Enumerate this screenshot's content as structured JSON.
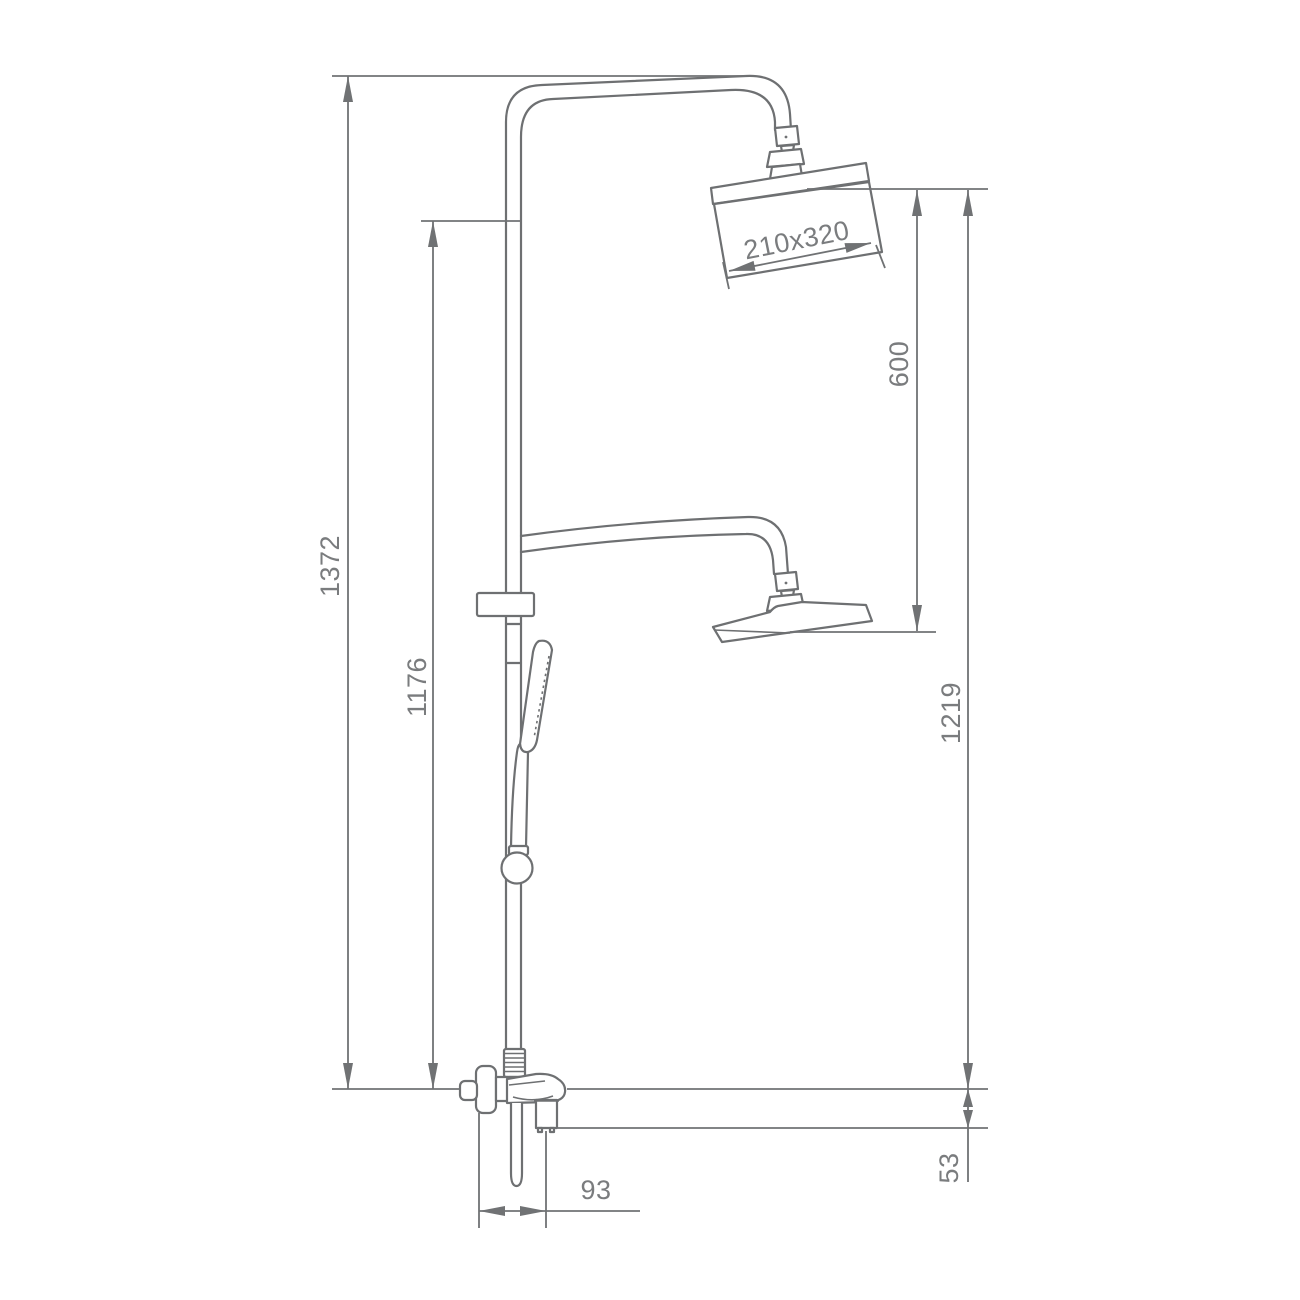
{
  "diagram": {
    "type": "technical-drawing",
    "subject": "thermostatic shower column with overhead shower, hand shower and bath mixer",
    "labels": {
      "overall_height": "1372",
      "riser_height": "1176",
      "head_drop": "600",
      "column_height": "1219",
      "mixer_offset": "53",
      "mixer_depth": "93",
      "shower_head_size": "210x320"
    },
    "colors": {
      "line": "#6e7072",
      "dimension_line": "#707274",
      "text": "#7a7c7e",
      "background": "#ffffff"
    }
  }
}
